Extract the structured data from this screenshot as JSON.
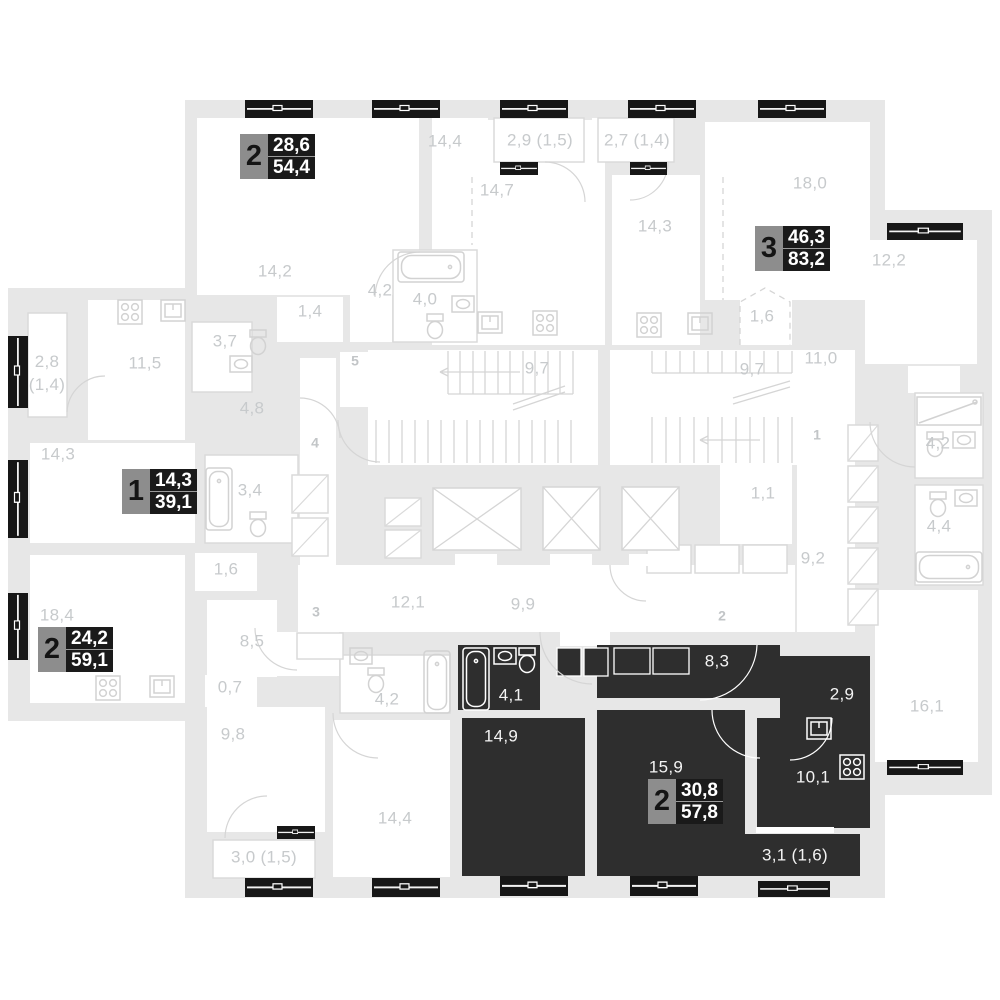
{
  "plan": {
    "colors": {
      "wall": "#e7e7e7",
      "room": "#ffffff",
      "line": "#d5d5d5",
      "label": "#c7cacc",
      "dark_apartment": "#2e2e2e",
      "dark_label": "#f4f4f4",
      "window": "#171717",
      "badge_number_bg": "#8d8d8d",
      "badge_values_bg": "#1a1a1a",
      "badge_values_color": "#ffffff"
    },
    "badges": [
      {
        "num": "2",
        "living": "28,6",
        "total": "54,4",
        "x": 240,
        "y": 134,
        "variant": "light"
      },
      {
        "num": "3",
        "living": "46,3",
        "total": "83,2",
        "x": 755,
        "y": 226,
        "variant": "light"
      },
      {
        "num": "1",
        "living": "14,3",
        "total": "39,1",
        "x": 122,
        "y": 469,
        "variant": "light"
      },
      {
        "num": "2",
        "living": "24,2",
        "total": "59,1",
        "x": 38,
        "y": 627,
        "variant": "light"
      },
      {
        "num": "2",
        "living": "30,8",
        "total": "57,8",
        "x": 648,
        "y": 779,
        "variant": "dark"
      }
    ],
    "labels": [
      {
        "t": "14,2",
        "x": 275,
        "y": 272,
        "k": "room"
      },
      {
        "t": "1,4",
        "x": 310,
        "y": 312,
        "k": "room"
      },
      {
        "t": "14,4",
        "x": 445,
        "y": 142,
        "k": "room"
      },
      {
        "t": "2,9 (1,5)",
        "x": 540,
        "y": 141,
        "k": "room"
      },
      {
        "t": "14,7",
        "x": 497,
        "y": 191,
        "k": "room"
      },
      {
        "t": "2,7 (1,4)",
        "x": 637,
        "y": 141,
        "k": "room"
      },
      {
        "t": "14,3",
        "x": 655,
        "y": 227,
        "k": "room"
      },
      {
        "t": "18,0",
        "x": 810,
        "y": 184,
        "k": "room"
      },
      {
        "t": "1,6",
        "x": 762,
        "y": 317,
        "k": "room"
      },
      {
        "t": "12,2",
        "x": 889,
        "y": 261,
        "k": "room"
      },
      {
        "t": "4,2",
        "x": 380,
        "y": 291,
        "k": "room"
      },
      {
        "t": "4,0",
        "x": 425,
        "y": 300,
        "k": "room"
      },
      {
        "t": "3,7",
        "x": 225,
        "y": 342,
        "k": "room"
      },
      {
        "t": "2,8\n(1,4)",
        "x": 47,
        "y": 374,
        "k": "room"
      },
      {
        "t": "11,5",
        "x": 145,
        "y": 364,
        "k": "room"
      },
      {
        "t": "4,8",
        "x": 252,
        "y": 409,
        "k": "room"
      },
      {
        "t": "9,7",
        "x": 537,
        "y": 369,
        "k": "room"
      },
      {
        "t": "9,7",
        "x": 752,
        "y": 370,
        "k": "room"
      },
      {
        "t": "11,0",
        "x": 821,
        "y": 359,
        "k": "room"
      },
      {
        "t": "14,3",
        "x": 58,
        "y": 455,
        "k": "room"
      },
      {
        "t": "3,4",
        "x": 250,
        "y": 491,
        "k": "room"
      },
      {
        "t": "1,1",
        "x": 763,
        "y": 494,
        "k": "room"
      },
      {
        "t": "4,2",
        "x": 938,
        "y": 444,
        "k": "room"
      },
      {
        "t": "4,4",
        "x": 939,
        "y": 527,
        "k": "room"
      },
      {
        "t": "9,2",
        "x": 813,
        "y": 559,
        "k": "room"
      },
      {
        "t": "1,6",
        "x": 226,
        "y": 570,
        "k": "room"
      },
      {
        "t": "18,4",
        "x": 57,
        "y": 616,
        "k": "room"
      },
      {
        "t": "12,1",
        "x": 408,
        "y": 603,
        "k": "room"
      },
      {
        "t": "9,9",
        "x": 523,
        "y": 605,
        "k": "room"
      },
      {
        "t": "8,5",
        "x": 252,
        "y": 642,
        "k": "room"
      },
      {
        "t": "0,7",
        "x": 230,
        "y": 688,
        "k": "room"
      },
      {
        "t": "9,8",
        "x": 233,
        "y": 735,
        "k": "room"
      },
      {
        "t": "3,0 (1,5)",
        "x": 264,
        "y": 858,
        "k": "room"
      },
      {
        "t": "14,4",
        "x": 395,
        "y": 819,
        "k": "room"
      },
      {
        "t": "4,2",
        "x": 387,
        "y": 700,
        "k": "room"
      },
      {
        "t": "16,1",
        "x": 927,
        "y": 707,
        "k": "room"
      },
      {
        "t": "5",
        "x": 355,
        "y": 361,
        "k": "num"
      },
      {
        "t": "4",
        "x": 315,
        "y": 443,
        "k": "num"
      },
      {
        "t": "3",
        "x": 316,
        "y": 612,
        "k": "num"
      },
      {
        "t": "1",
        "x": 817,
        "y": 435,
        "k": "num"
      },
      {
        "t": "2",
        "x": 722,
        "y": 616,
        "k": "num"
      },
      {
        "t": "4,1",
        "x": 511,
        "y": 696,
        "k": "dark"
      },
      {
        "t": "8,3",
        "x": 717,
        "y": 662,
        "k": "dark"
      },
      {
        "t": "2,9",
        "x": 842,
        "y": 695,
        "k": "dark"
      },
      {
        "t": "14,9",
        "x": 501,
        "y": 737,
        "k": "dark"
      },
      {
        "t": "15,9",
        "x": 666,
        "y": 768,
        "k": "dark"
      },
      {
        "t": "10,1",
        "x": 813,
        "y": 778,
        "k": "dark"
      },
      {
        "t": "3,1 (1,6)",
        "x": 795,
        "y": 856,
        "k": "dark"
      }
    ]
  }
}
